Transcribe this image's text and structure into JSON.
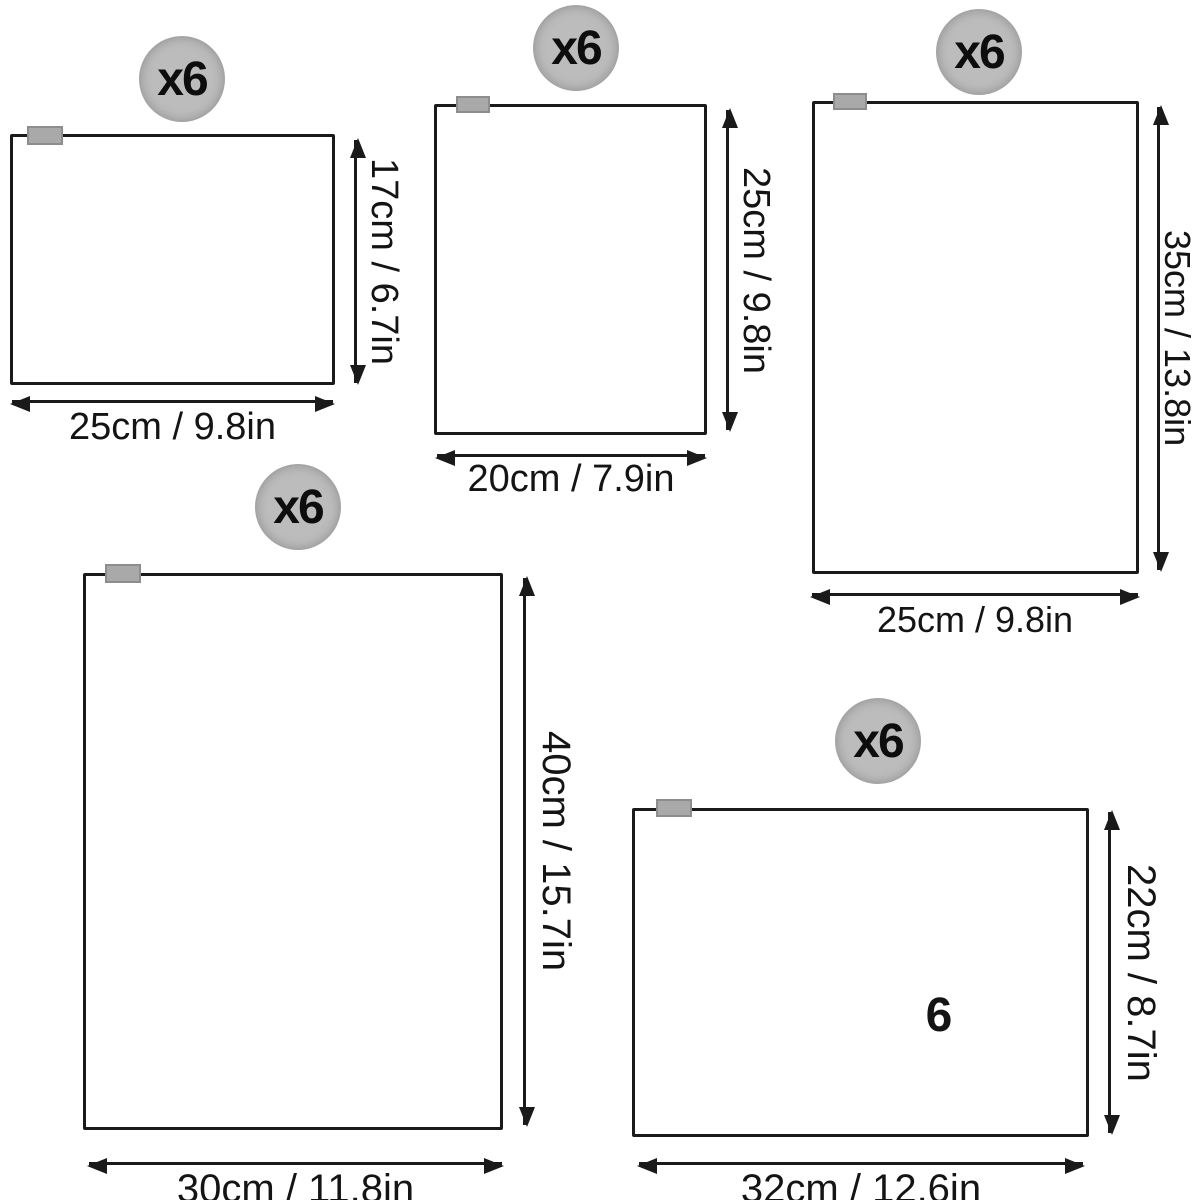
{
  "colors": {
    "background": "#ffffff",
    "line": "#1a1a1a",
    "text": "#141414",
    "badge_fill": "#bcbcbc",
    "tab_fill": "#a9a9a9"
  },
  "bags": [
    {
      "name": "bag-1-top-left",
      "qty_label": "x6",
      "width_cm": 25,
      "width_in": 9.8,
      "height_cm": 17,
      "height_in": 6.7,
      "width_label": "25cm / 9.8in",
      "height_label": "17cm / 6.7in"
    },
    {
      "name": "bag-2-top-middle",
      "qty_label": "x6",
      "width_cm": 20,
      "width_in": 7.9,
      "height_cm": 25,
      "height_in": 9.8,
      "width_label": "20cm / 7.9in",
      "height_label": "25cm / 9.8in"
    },
    {
      "name": "bag-3-top-right",
      "qty_label": "x6",
      "width_cm": 25,
      "width_in": 9.8,
      "height_cm": 35,
      "height_in": 13.8,
      "width_label": "25cm / 9.8in",
      "height_label": "35cm / 13.8in"
    },
    {
      "name": "bag-4-bottom-left",
      "qty_label": "x6",
      "width_cm": 30,
      "width_in": 11.8,
      "height_cm": 40,
      "height_in": 15.7,
      "width_label": "30cm / 11.8in",
      "height_label": "40cm / 15.7in"
    },
    {
      "name": "bag-5-bottom-right",
      "qty_label": "x6",
      "width_cm": 32,
      "width_in": 12.6,
      "height_cm": 22,
      "height_in": 8.7,
      "width_label": "32cm / 12.6in",
      "height_label": "22cm / 8.7in",
      "inner_count": "6"
    }
  ]
}
